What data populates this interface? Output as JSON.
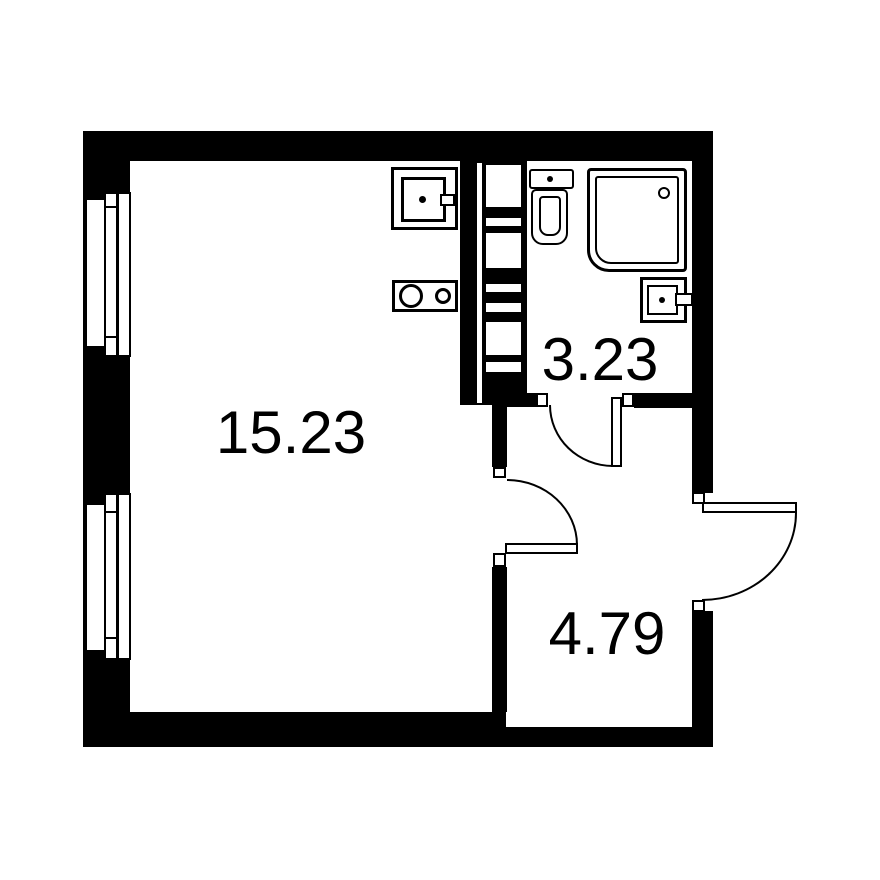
{
  "colors": {
    "background": "#ffffff",
    "walls": "#000000",
    "text": "#000000"
  },
  "rooms": [
    {
      "id": "main-room",
      "area_label": "15.23"
    },
    {
      "id": "bathroom",
      "area_label": "3.23"
    },
    {
      "id": "hallway",
      "area_label": "4.79"
    }
  ],
  "fixtures": [
    {
      "icon": "window-icon",
      "location": "left-wall-upper"
    },
    {
      "icon": "window-icon",
      "location": "left-wall-lower"
    },
    {
      "icon": "kitchen-sink-icon",
      "location": "main-room"
    },
    {
      "icon": "stove-icon",
      "location": "main-room"
    },
    {
      "icon": "vent-shaft-icon",
      "location": "between-main-room-and-bathroom"
    },
    {
      "icon": "toilet-icon",
      "location": "bathroom"
    },
    {
      "icon": "shower-icon",
      "location": "bathroom"
    },
    {
      "icon": "washbasin-icon",
      "location": "bathroom"
    },
    {
      "icon": "door-swing-icon",
      "location": "bathroom-doorway"
    },
    {
      "icon": "door-swing-icon",
      "location": "main-room-doorway"
    },
    {
      "icon": "door-swing-icon",
      "location": "apartment-entrance"
    }
  ]
}
